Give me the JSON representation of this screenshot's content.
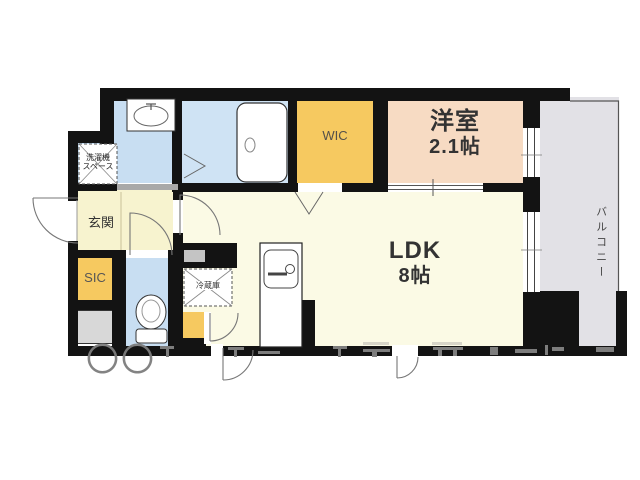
{
  "plan": {
    "rooms": {
      "ldk": {
        "name": "LDK",
        "size": "8帖"
      },
      "youshitsu": {
        "name": "洋室",
        "size": "2.1帖"
      },
      "wic": {
        "name": "WIC"
      },
      "sic": {
        "name": "SIC"
      },
      "genkan": {
        "name": "玄関"
      },
      "balcony": {
        "name": "バルコニー"
      }
    },
    "fixtures": {
      "washer_space": {
        "line1": "洗濯機",
        "line2": "スペース"
      },
      "fridge": {
        "name": "冷蔵庫"
      }
    },
    "watermark": "〇〇",
    "colors": {
      "wall": "#131313",
      "wet_area_blue": "#c8def2",
      "closet_orange": "#f6c960",
      "bedroom_peach": "#f7dbc3",
      "ldk_cream": "#fbfae5",
      "genkan_yellow": "#f7f3cf",
      "balcony_gray": "#e2e1e6"
    }
  }
}
